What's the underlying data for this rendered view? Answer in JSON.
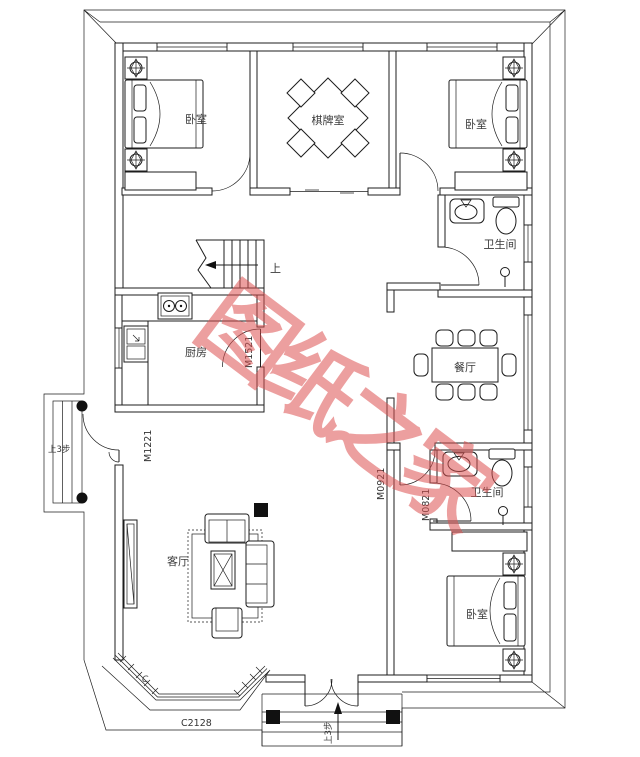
{
  "title": "first-floor-plan",
  "watermark": {
    "text": "图纸之家",
    "color": "#dd5252"
  },
  "rooms": {
    "bedroom_top_left": "卧室",
    "game_room": "棋牌室",
    "bedroom_top_right": "卧室",
    "bathroom_top": "卫生间",
    "kitchen": "厨房",
    "dining_room": "餐厅",
    "bathroom_bottom": "卫生间",
    "bedroom_bottom_right": "卧室",
    "living_room": "客厅"
  },
  "labels": {
    "door_main_left": "M1221",
    "door_kitchen": "M1521",
    "door_hall": "M0921",
    "door_bathroom": "M0821",
    "bay_window": "C2128",
    "stairs_up": "上",
    "steps_left": "上3步",
    "steps_bottom": "上3步",
    "corner_mark": "C"
  },
  "colors": {
    "line": "#1d1d1d",
    "label": "#3a3a3a",
    "watermark": "#dd5252",
    "background": "#ffffff"
  }
}
